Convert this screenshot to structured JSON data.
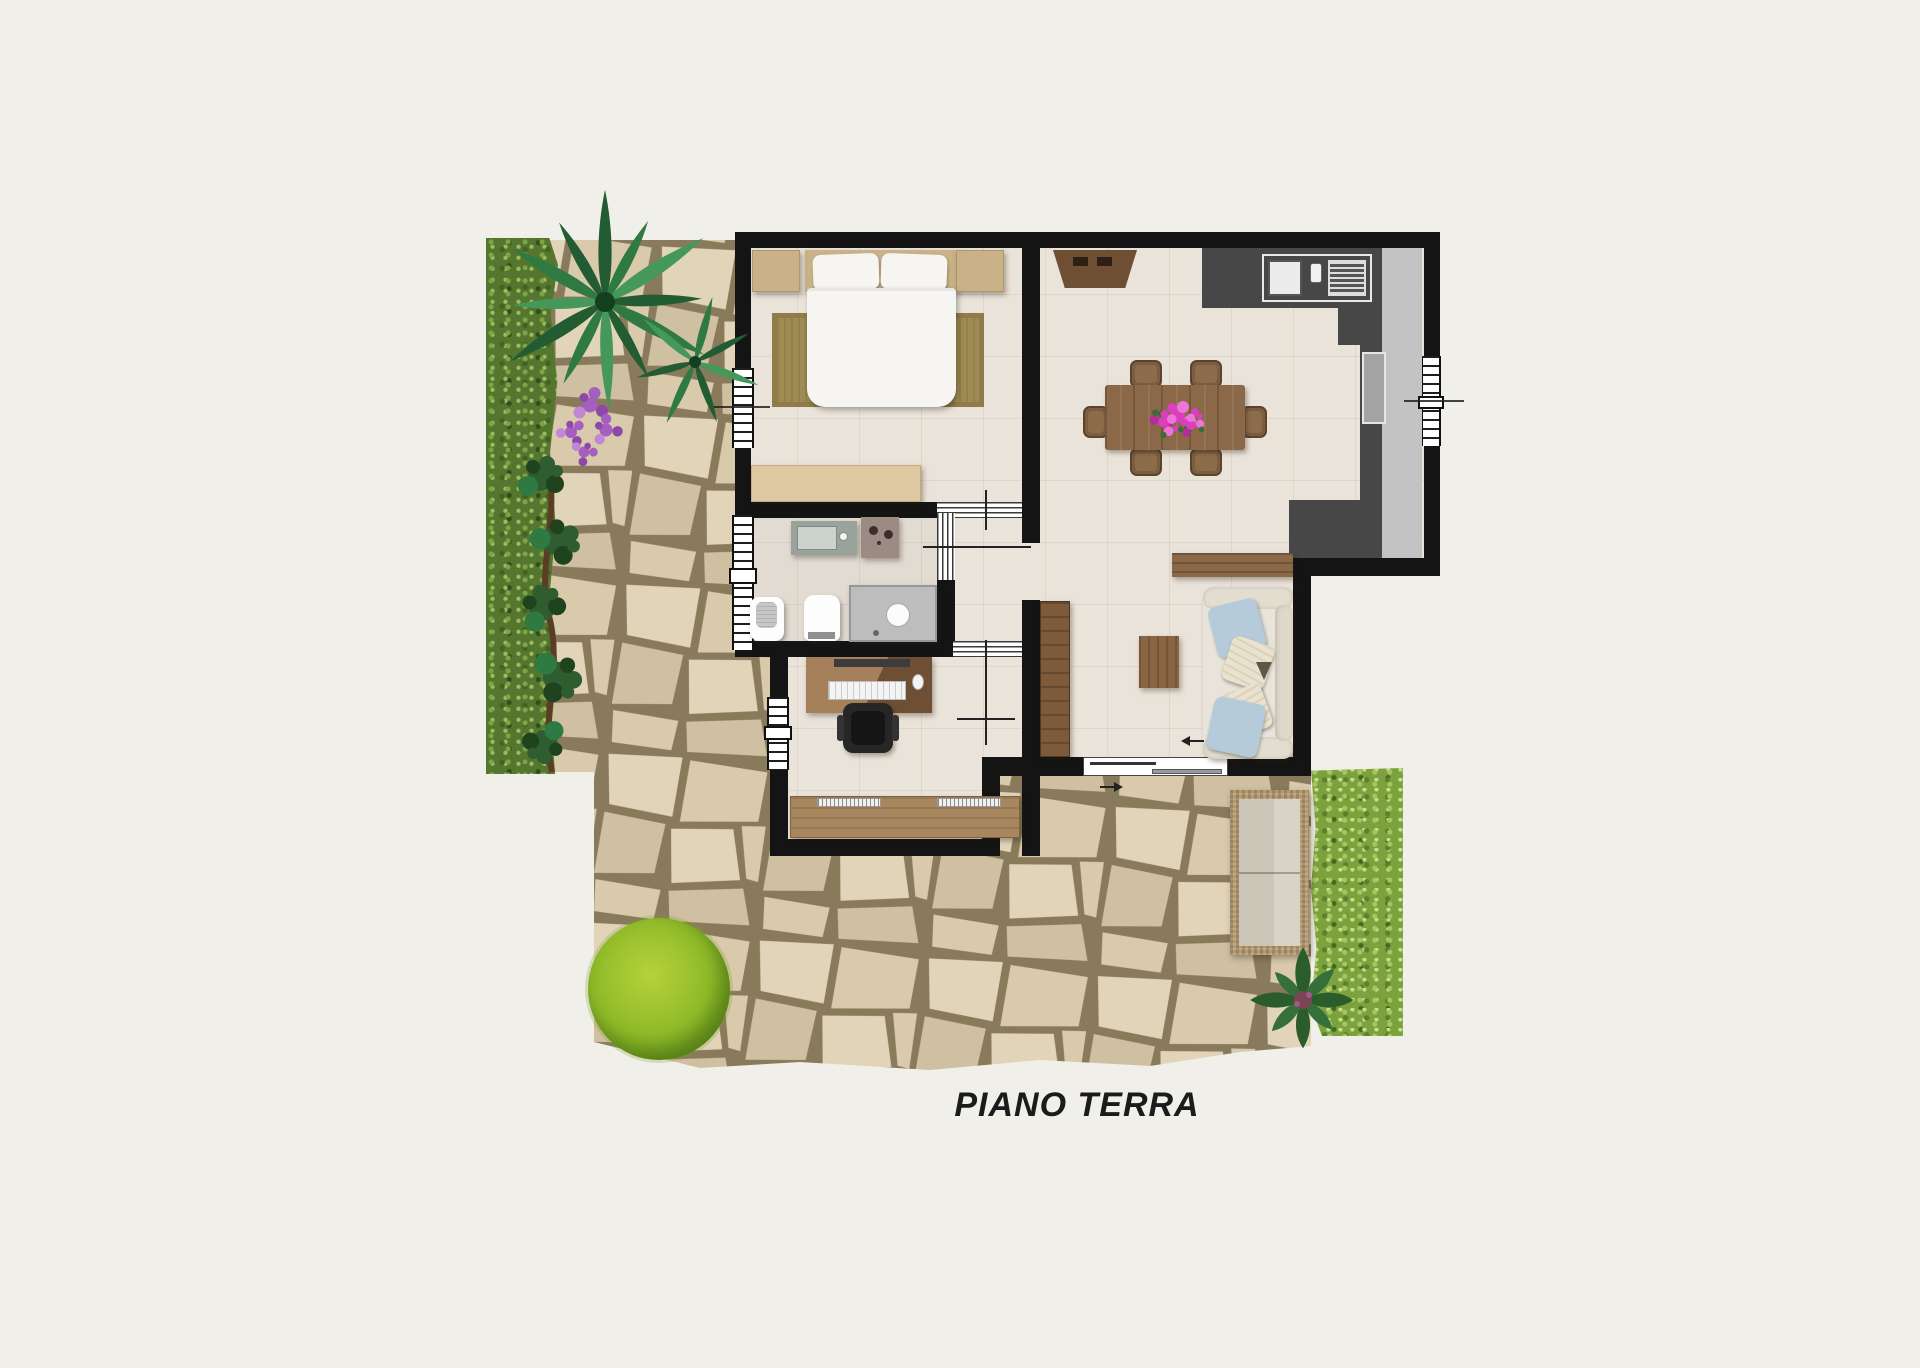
{
  "title": {
    "label": "PIANO TERRA"
  },
  "colors": {
    "background": "#f1efe9",
    "wall": "#141414",
    "floor": "#eae3d9",
    "stone_gap": "#8a7a5c",
    "stone_1": "#e2d4b8",
    "stone_2": "#d9caac",
    "stone_3": "#cfc0a2",
    "ivy": "#55762f",
    "grass": "#7ca23e",
    "bush": "#8fba28",
    "counter_dark": "#474747",
    "counter_light": "#c3c3c3",
    "appliance": "#a3a3a3",
    "wood": "#8a6848",
    "wood_dark": "#6e4f33",
    "wood_light": "#a5805a",
    "rug": "#a08b52",
    "tan": "#c9b188",
    "tan_light": "#ddc8a2",
    "white_furn": "#f7f5f1",
    "sofa_body": "#e9e4d9",
    "pillow_blue": "#b6cbd9",
    "pillow_cream": "#eae2cd",
    "chair_dark": "#262626",
    "vanity": "#9aa29c",
    "washer": "#9c8b83",
    "shower": "#bdbdbd",
    "pink": "#dc3fbe",
    "purple": "#a55fc0",
    "wicker": "#b4996f",
    "cushion": "#ccc6b9",
    "palm_dark": "#235c33",
    "palm_mid": "#2f7a43",
    "palm_light": "#46975a",
    "vine": "#2f5d2f",
    "vine_dark": "#1f431f",
    "stem": "#5b3d26",
    "plant": "#2a5c2c",
    "plant_center": "#7a4656",
    "title_color": "#1b1b1b"
  }
}
